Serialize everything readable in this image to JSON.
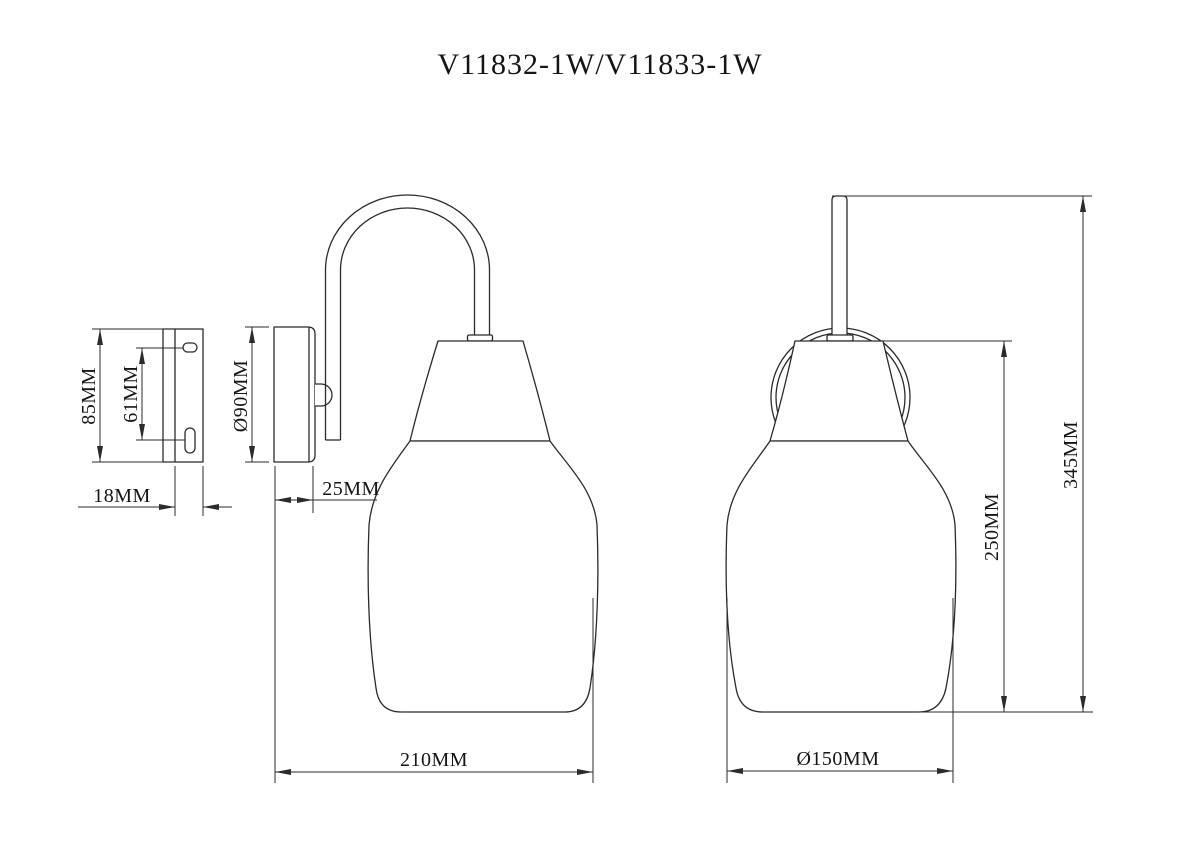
{
  "title": "V11832-1W/V11833-1W",
  "drawing": {
    "ink_color": "#2b2b2b",
    "background_color": "#ffffff",
    "type": "wall-lamp dimension drawing",
    "views": [
      "bracket side view",
      "lamp side view",
      "lamp front view"
    ]
  },
  "views": {
    "bracket_side": {
      "dims": {
        "height": "85MM",
        "slot_spacing": "61MM",
        "depth": "18MM"
      }
    },
    "lamp_side": {
      "dims": {
        "backplate_diameter": "Ø90MM",
        "backplate_depth": "25MM",
        "projection": "210MM"
      }
    },
    "lamp_front": {
      "dims": {
        "overall_height": "345MM",
        "glass_height": "250MM",
        "glass_diameter": "Ø150MM"
      }
    }
  }
}
